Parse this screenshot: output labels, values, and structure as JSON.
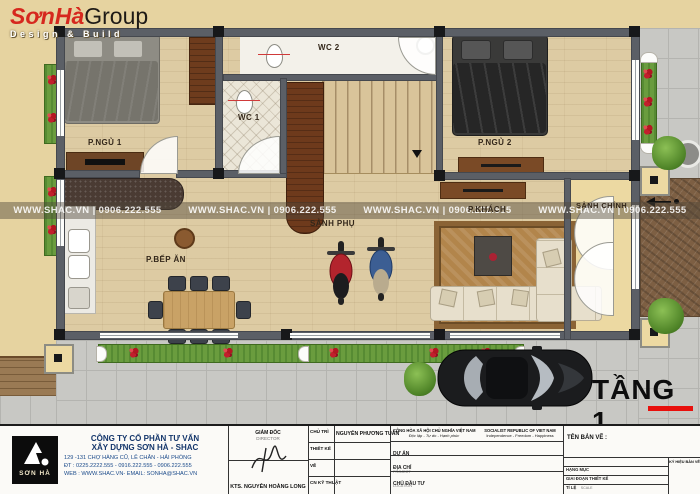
{
  "logo": {
    "brand_primary": "SơnHà",
    "brand_secondary": "Group",
    "tagline": "Design & Build"
  },
  "watermark_text": "WWW.SHAC.VN  |  0906.222.555",
  "plan": {
    "floor_title": "TẦNG 1",
    "rooms": {
      "bedroom1": "P.NGỦ 1",
      "bedroom2": "P.NGỦ 2",
      "wc1": "WC 1",
      "wc2": "WC 2",
      "kitchen_dining": "P.BẾP ĂN",
      "side_hall": "SẢNH PHỤ",
      "living": "P.KHÁCH",
      "main_hall": "SẢNH CHÍNH"
    }
  },
  "title_block": {
    "company": {
      "logo_mark": "SƠN HÀ",
      "name_line1": "CÔNG TY CỔ PHẦN TƯ VẤN",
      "name_line2": "XÂY DỰNG SƠN HÀ - SHAC",
      "address": "129 -131 CHỢ HÀNG CŨ, LÊ CHÂN - HẢI PHÒNG",
      "phone": "ĐT : 0225.2222.555 - 0916.222.555 - 0906.222.555",
      "web": "WEB : WWW.SHAC.VN- EMAIL: SONHA@SHAC.VN"
    },
    "director": {
      "label_vi": "GIÁM ĐỐC",
      "label_en": "DIRECTOR",
      "name": "KTS. NGUYỄN HOÀNG LONG"
    },
    "staff_rows": [
      {
        "label": "CHỦ TRÌ",
        "value": "NGUYỄN PHƯƠNG TUẤN"
      },
      {
        "label": "THIẾT KẾ",
        "value": ""
      },
      {
        "label": "VẼ",
        "value": ""
      },
      {
        "label": "CN KỸ THUẬT",
        "value": ""
      }
    ],
    "republic": {
      "vi_line1": "CỘNG HÒA XÃ HỘI CHỦ NGHĨA VIỆT NAM",
      "vi_line2": "Độc lập - Tự do - Hạnh phúc",
      "en_line1": "SOCIALIST REPUBLIC OF VIET NAM",
      "en_line2": "Independence - Freedom - Happiness"
    },
    "project_rows": [
      {
        "label_vi": "DỰ ÁN",
        "label_en": "PROJECT"
      },
      {
        "label_vi": "ĐỊA CHỈ",
        "label_en": "LOCATION"
      },
      {
        "label_vi": "CHỦ ĐẦU TƯ",
        "label_en": "INVESTOR"
      }
    ],
    "drawing": {
      "name_label": "TÊN BẢN VẼ :",
      "meta_rows": [
        {
          "label_vi": "HẠNG MỤC",
          "label_en": ""
        },
        {
          "label_vi": "GIAI ĐOẠN THIẾT KẾ",
          "label_en": ""
        },
        {
          "label_vi": "TỈ LỆ",
          "label_en": "SCALE"
        },
        {
          "label_vi": "NGÀY THÁNG",
          "label_en": "DATE"
        }
      ],
      "code_label": "KÝ HIỆU BẢN VẼ"
    }
  },
  "colors": {
    "paper_tan": "#e6d3a0",
    "wall_gray": "#5b5f66",
    "accent_red": "#e8100c",
    "planter_green": "#6a9c3e",
    "flower_red": "#c11f2c",
    "moto_red": "#b3242d",
    "moto_blue": "#3c5e93",
    "watermark_band": "rgba(80,70,58,0.45)"
  }
}
